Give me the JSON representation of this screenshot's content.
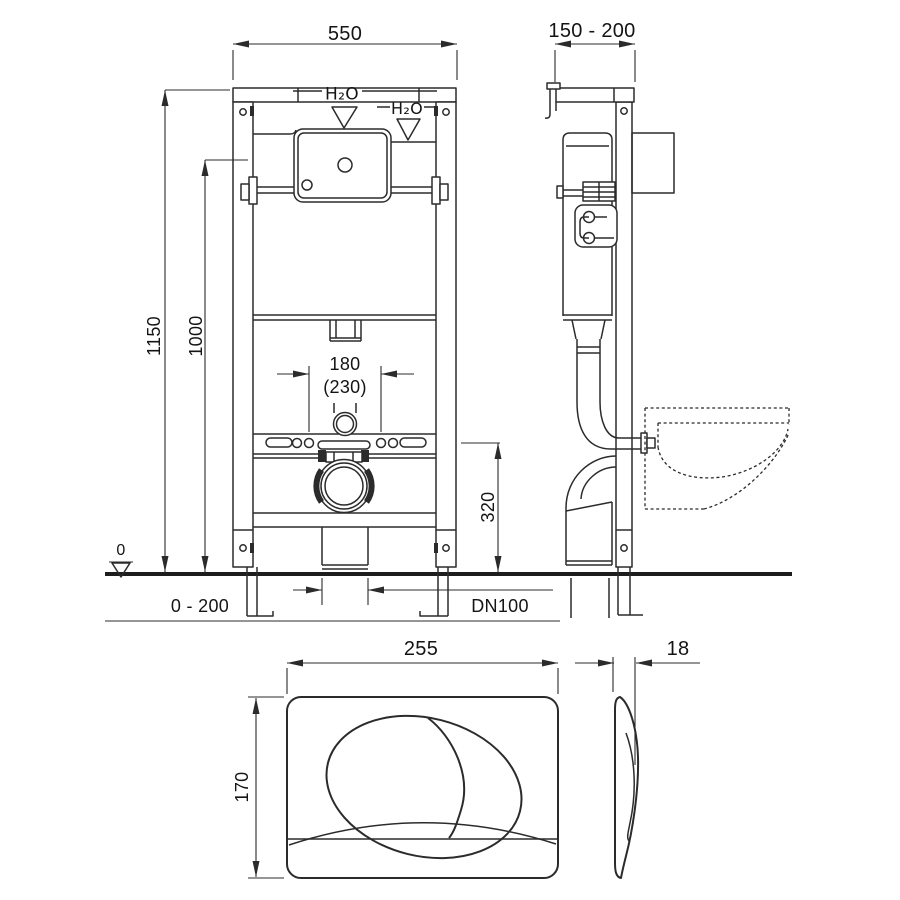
{
  "style": {
    "line_color": "#2b2b2b",
    "text_color": "#141414",
    "background": "#ffffff"
  },
  "front_view": {
    "dim_width_top": "550",
    "dim_height_total": "1150",
    "dim_height_frame": "1000",
    "water_label_center": "H₂O",
    "water_label_right": "H₂O",
    "dim_flush_spacing": "180",
    "dim_flush_spacing_alt": "(230)",
    "dim_outlet_height": "320",
    "datum_label": "0",
    "dim_foot_range": "0 - 200",
    "drain_label": "DN100"
  },
  "side_view": {
    "dim_depth_range": "150 - 200"
  },
  "flush_plate": {
    "dim_width": "255",
    "dim_height": "170",
    "dim_thickness": "18"
  }
}
